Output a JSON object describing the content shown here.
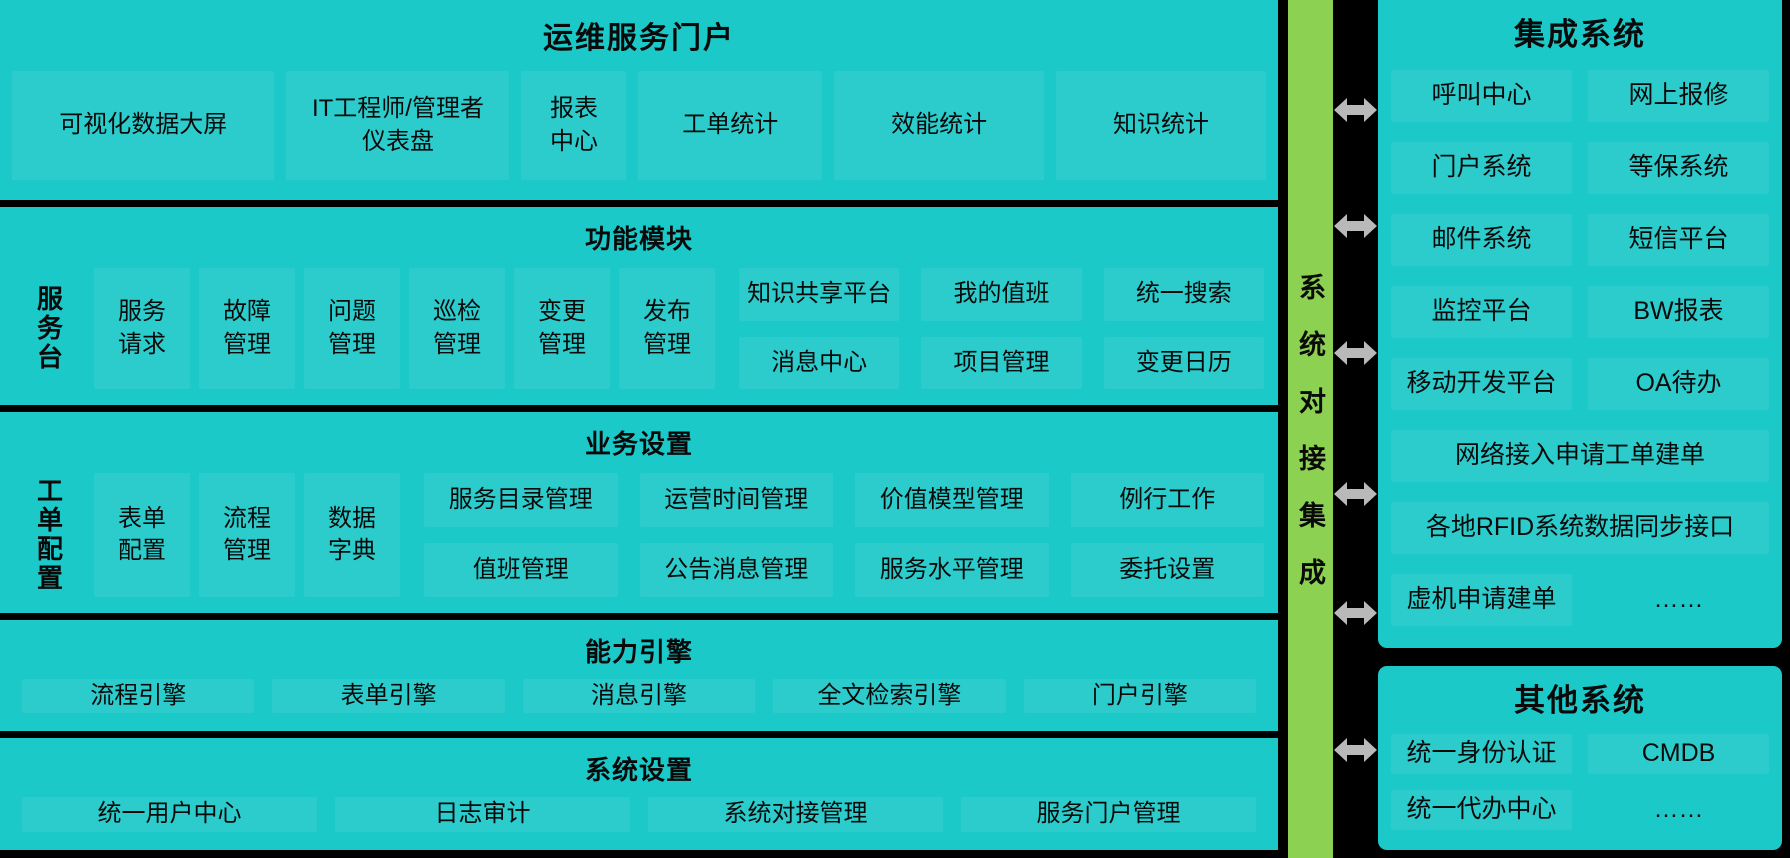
{
  "colors": {
    "panel_teal": "#1cc9c9",
    "connector_green": "#8cd151",
    "divider_black": "#000000",
    "arrow_gray": "#b9b9b9",
    "text": "#0a0a0a"
  },
  "left": {
    "title": "运维服务门户",
    "dashboard": [
      "可视化数据大屏",
      "IT工程师/管理者\n仪表盘",
      "报表\n中心",
      "工单统计",
      "效能统计",
      "知识统计"
    ],
    "func": {
      "header": "功能模块",
      "side": "服务台",
      "modules": [
        "服务\n请求",
        "故障\n管理",
        "问题\n管理",
        "巡检\n管理",
        "变更\n管理",
        "发布\n管理"
      ],
      "grid": [
        "知识共享平台",
        "我的值班",
        "统一搜索",
        "消息中心",
        "项目管理",
        "变更日历"
      ]
    },
    "biz": {
      "header": "业务设置",
      "side": "工单配置",
      "modules": [
        "表单\n配置",
        "流程\n管理",
        "数据\n字典"
      ],
      "grid": [
        "服务目录管理",
        "运营时间管理",
        "价值模型管理",
        "例行工作",
        "值班管理",
        "公告消息管理",
        "服务水平管理",
        "委托设置"
      ]
    },
    "engine": {
      "header": "能力引擎",
      "items": [
        "流程引擎",
        "表单引擎",
        "消息引擎",
        "全文检索引擎",
        "门户引擎"
      ]
    },
    "sys": {
      "header": "系统设置",
      "items": [
        "统一用户中心",
        "日志审计",
        "系统对接管理",
        "服务门户管理"
      ]
    }
  },
  "connector": {
    "label": "系统对接集成"
  },
  "right": {
    "integrated": {
      "title": "集成系统",
      "pairs": [
        [
          "呼叫中心",
          "网上报修"
        ],
        [
          "门户系统",
          "等保系统"
        ],
        [
          "邮件系统",
          "短信平台"
        ],
        [
          "监控平台",
          "BW报表"
        ],
        [
          "移动开发平台",
          "OA待办"
        ]
      ],
      "full": [
        "网络接入申请工单建单",
        "各地RFID系统数据同步接口"
      ],
      "last": [
        "虚机申请建单",
        "……"
      ]
    },
    "others": {
      "title": "其他系统",
      "pairs": [
        [
          "统一身份认证",
          "CMDB"
        ],
        [
          "统一代办中心",
          "……"
        ]
      ]
    }
  }
}
